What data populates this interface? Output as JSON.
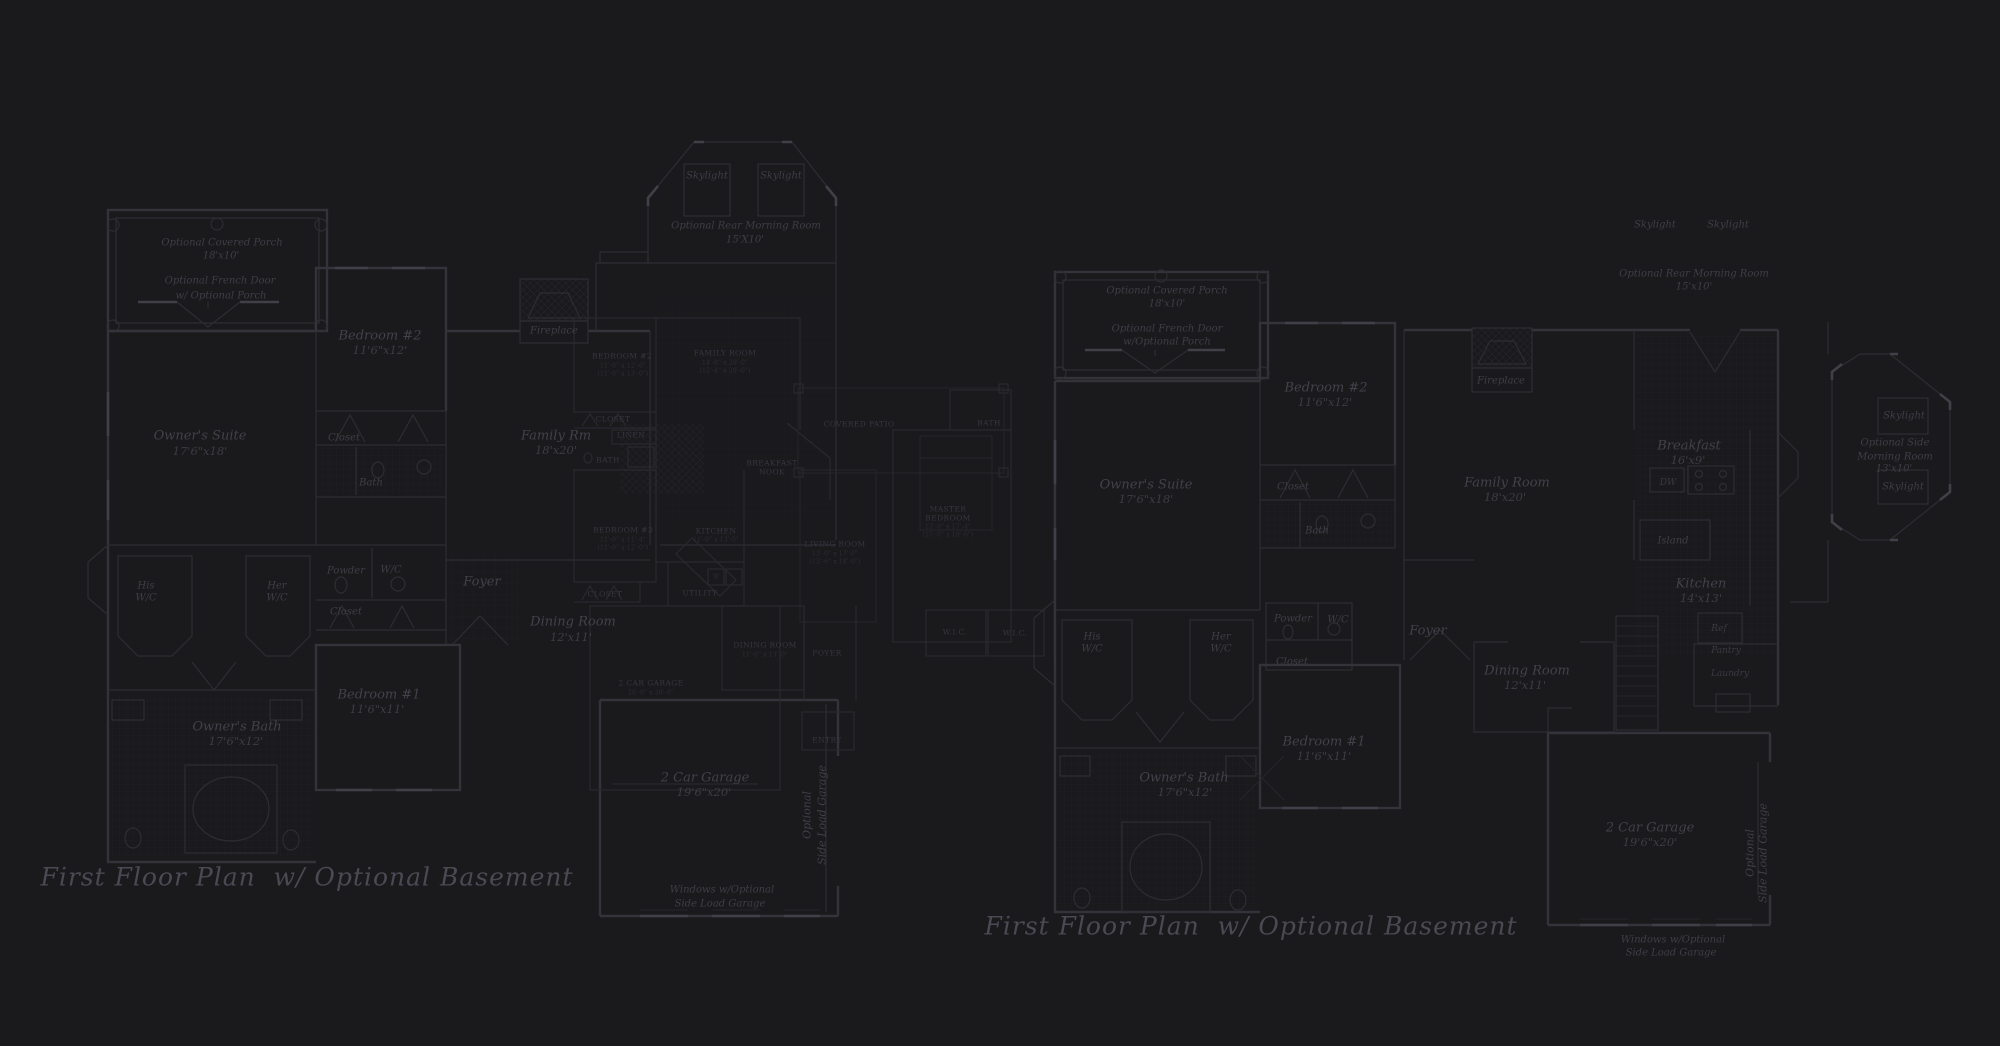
{
  "colors": {
    "background": "#1a191c",
    "wall_line": "#34333a",
    "faint_line": "#2e2d33",
    "bright_line": "#413f47",
    "label_text": "#43414a",
    "caption_text": "#4b4953"
  },
  "plans": {
    "left": {
      "caption": "First Floor Plan  w/ Optional Basement",
      "labels": [
        {
          "t": "Optional Covered Porch",
          "x": 222,
          "y": 243,
          "c": "rms"
        },
        {
          "t": "18'x10'",
          "x": 221,
          "y": 256,
          "c": "rms"
        },
        {
          "t": "Optional French Door",
          "x": 220,
          "y": 281,
          "c": "rms"
        },
        {
          "t": "w/ Optional Porch",
          "x": 221,
          "y": 296,
          "c": "rms"
        },
        {
          "t": "Bedroom #2",
          "x": 380,
          "y": 336,
          "c": "rm"
        },
        {
          "t": "11'6\"x12'",
          "x": 380,
          "y": 350,
          "c": "dim"
        },
        {
          "t": "Owner's Suite",
          "x": 200,
          "y": 436,
          "c": "rm"
        },
        {
          "t": "17'6\"x18'",
          "x": 200,
          "y": 451,
          "c": "dim"
        },
        {
          "t": "Closet",
          "x": 344,
          "y": 438,
          "c": "rms"
        },
        {
          "t": "Bath",
          "x": 371,
          "y": 483,
          "c": "rms"
        },
        {
          "t": "His",
          "x": 146,
          "y": 586,
          "c": "rms"
        },
        {
          "t": "W/C",
          "x": 146,
          "y": 598,
          "c": "rms"
        },
        {
          "t": "Her",
          "x": 277,
          "y": 586,
          "c": "rms"
        },
        {
          "t": "W/C",
          "x": 277,
          "y": 598,
          "c": "rms"
        },
        {
          "t": "Powder",
          "x": 346,
          "y": 571,
          "c": "rms"
        },
        {
          "t": "W/C",
          "x": 391,
          "y": 570,
          "c": "rms"
        },
        {
          "t": "Closet",
          "x": 346,
          "y": 612,
          "c": "rms"
        },
        {
          "t": "Foyer",
          "x": 482,
          "y": 582,
          "c": "rm"
        },
        {
          "t": "Dining Room",
          "x": 573,
          "y": 622,
          "c": "rm"
        },
        {
          "t": "12'x11'",
          "x": 571,
          "y": 637,
          "c": "dim"
        },
        {
          "t": "Family Rm",
          "x": 556,
          "y": 436,
          "c": "rm"
        },
        {
          "t": "18'x20'",
          "x": 556,
          "y": 450,
          "c": "dim"
        },
        {
          "t": "Fireplace",
          "x": 554,
          "y": 331,
          "c": "rms"
        },
        {
          "t": "Skylight",
          "x": 707,
          "y": 176,
          "c": "rms"
        },
        {
          "t": "Skylight",
          "x": 781,
          "y": 176,
          "c": "rms"
        },
        {
          "t": "Optional Rear Morning Room",
          "x": 746,
          "y": 226,
          "c": "rms"
        },
        {
          "t": "15'X10'",
          "x": 745,
          "y": 240,
          "c": "rms"
        },
        {
          "t": "Bedroom #1",
          "x": 379,
          "y": 695,
          "c": "rm"
        },
        {
          "t": "11'6\"x11'",
          "x": 377,
          "y": 709,
          "c": "dim"
        },
        {
          "t": "Owner's Bath",
          "x": 237,
          "y": 727,
          "c": "rm"
        },
        {
          "t": "17'6\"x12'",
          "x": 236,
          "y": 741,
          "c": "dim"
        },
        {
          "t": "2 Car Garage",
          "x": 705,
          "y": 778,
          "c": "rm"
        },
        {
          "t": "19'6\"x20'",
          "x": 704,
          "y": 792,
          "c": "dim"
        },
        {
          "t": "Optional",
          "x": 807,
          "y": 815,
          "c": "vert"
        },
        {
          "t": "Side Load Garage",
          "x": 822,
          "y": 815,
          "c": "vert"
        },
        {
          "t": "Windows w/Optional",
          "x": 722,
          "y": 890,
          "c": "rms"
        },
        {
          "t": "Side Load Garage",
          "x": 720,
          "y": 904,
          "c": "rms"
        }
      ]
    },
    "middle": {
      "labels": [
        {
          "t": "BEDROOM #2",
          "x": 622,
          "y": 356,
          "c": "caps"
        },
        {
          "t": "11'-0\" x 12'-6\"",
          "x": 623,
          "y": 366,
          "c": "capsdim"
        },
        {
          "t": "(11'-0\" x 13'-0\")",
          "x": 623,
          "y": 374,
          "c": "capsdim"
        },
        {
          "t": "FAMILY ROOM",
          "x": 725,
          "y": 353,
          "c": "caps"
        },
        {
          "t": "14'-8\" x 20'-0\"",
          "x": 725,
          "y": 363,
          "c": "capsdim"
        },
        {
          "t": "(15'-4\" x 20'-0\")",
          "x": 725,
          "y": 371,
          "c": "capsdim"
        },
        {
          "t": "CLOSET",
          "x": 613,
          "y": 419,
          "c": "caps"
        },
        {
          "t": "LINEN",
          "x": 631,
          "y": 435,
          "c": "caps"
        },
        {
          "t": "BATH",
          "x": 608,
          "y": 460,
          "c": "caps"
        },
        {
          "t": "BEDROOM #3",
          "x": 623,
          "y": 530,
          "c": "caps"
        },
        {
          "t": "11'-0\" x 11'-4\"",
          "x": 623,
          "y": 540,
          "c": "capsdim"
        },
        {
          "t": "(11'-0\" x 12'-0\")",
          "x": 623,
          "y": 548,
          "c": "capsdim"
        },
        {
          "t": "KITCHEN",
          "x": 716,
          "y": 531,
          "c": "caps"
        },
        {
          "t": "11'-0\" x 13'-0\"",
          "x": 716,
          "y": 540,
          "c": "capsdim"
        },
        {
          "t": "BREAKFAST",
          "x": 772,
          "y": 463,
          "c": "caps"
        },
        {
          "t": "NOOK",
          "x": 772,
          "y": 472,
          "c": "caps"
        },
        {
          "t": "COVERED PATIO",
          "x": 859,
          "y": 424,
          "c": "caps"
        },
        {
          "t": "MASTER",
          "x": 948,
          "y": 509,
          "c": "caps"
        },
        {
          "t": "BEDROOM",
          "x": 948,
          "y": 518,
          "c": "caps"
        },
        {
          "t": "13'-0\" x 17'-4\"",
          "x": 948,
          "y": 527,
          "c": "capsdim"
        },
        {
          "t": "(15'-0\" x 19'-0\")",
          "x": 948,
          "y": 535,
          "c": "capsdim"
        },
        {
          "t": "LIVING ROOM",
          "x": 835,
          "y": 544,
          "c": "caps"
        },
        {
          "t": "13'-0\" x 17'-0\"",
          "x": 835,
          "y": 554,
          "c": "capsdim"
        },
        {
          "t": "(13'-6\" x 18'-0\")",
          "x": 835,
          "y": 562,
          "c": "capsdim"
        },
        {
          "t": "BATH",
          "x": 989,
          "y": 423,
          "c": "caps"
        },
        {
          "t": "W.I.C.",
          "x": 955,
          "y": 632,
          "c": "caps"
        },
        {
          "t": "W.I.C.",
          "x": 1015,
          "y": 633,
          "c": "caps"
        },
        {
          "t": "DINING ROOM",
          "x": 765,
          "y": 645,
          "c": "caps"
        },
        {
          "t": "11'-0\" x 13'-0\"",
          "x": 765,
          "y": 655,
          "c": "capsdim"
        },
        {
          "t": "FOYER",
          "x": 827,
          "y": 653,
          "c": "caps"
        },
        {
          "t": "UTILITY",
          "x": 700,
          "y": 593,
          "c": "caps"
        },
        {
          "t": "W",
          "x": 716,
          "y": 577,
          "c": "capsdim"
        },
        {
          "t": "CLOSET",
          "x": 605,
          "y": 594,
          "c": "caps"
        },
        {
          "t": "2 CAR GARAGE",
          "x": 651,
          "y": 683,
          "c": "caps"
        },
        {
          "t": "20'-0\" x 20'-8\"",
          "x": 651,
          "y": 693,
          "c": "capsdim"
        },
        {
          "t": "ENTRY",
          "x": 827,
          "y": 740,
          "c": "caps"
        }
      ]
    },
    "right": {
      "caption": "First Floor Plan  w/ Optional Basement",
      "labels": [
        {
          "t": "Optional Covered Porch",
          "x": 1167,
          "y": 291,
          "c": "rms"
        },
        {
          "t": "18'x10'",
          "x": 1167,
          "y": 304,
          "c": "rms"
        },
        {
          "t": "Optional French Door",
          "x": 1167,
          "y": 329,
          "c": "rms"
        },
        {
          "t": "w/Optional Porch",
          "x": 1167,
          "y": 342,
          "c": "rms"
        },
        {
          "t": "Bedroom #2",
          "x": 1326,
          "y": 388,
          "c": "rm"
        },
        {
          "t": "11'6\"x12'",
          "x": 1325,
          "y": 402,
          "c": "dim"
        },
        {
          "t": "Owner's Suite",
          "x": 1146,
          "y": 485,
          "c": "rm"
        },
        {
          "t": "17'6\"x18'",
          "x": 1146,
          "y": 499,
          "c": "dim"
        },
        {
          "t": "Closet",
          "x": 1293,
          "y": 487,
          "c": "rms"
        },
        {
          "t": "Bath",
          "x": 1317,
          "y": 531,
          "c": "rms"
        },
        {
          "t": "Family Room",
          "x": 1507,
          "y": 483,
          "c": "rm"
        },
        {
          "t": "18'x20'",
          "x": 1505,
          "y": 497,
          "c": "dim"
        },
        {
          "t": "Fireplace",
          "x": 1501,
          "y": 381,
          "c": "rms"
        },
        {
          "t": "Skylight",
          "x": 1655,
          "y": 225,
          "c": "rms"
        },
        {
          "t": "Skylight",
          "x": 1728,
          "y": 225,
          "c": "rms"
        },
        {
          "t": "Optional Rear Morning Room",
          "x": 1694,
          "y": 274,
          "c": "rms"
        },
        {
          "t": "15'x10'",
          "x": 1694,
          "y": 287,
          "c": "rms"
        },
        {
          "t": "Breakfast",
          "x": 1689,
          "y": 446,
          "c": "rm"
        },
        {
          "t": "16'x9'",
          "x": 1688,
          "y": 460,
          "c": "dim"
        },
        {
          "t": "DW",
          "x": 1668,
          "y": 483,
          "c": "xs"
        },
        {
          "t": "Island",
          "x": 1673,
          "y": 541,
          "c": "rms"
        },
        {
          "t": "Kitchen",
          "x": 1701,
          "y": 584,
          "c": "rm"
        },
        {
          "t": "14'x13'",
          "x": 1701,
          "y": 598,
          "c": "dim"
        },
        {
          "t": "Ref",
          "x": 1719,
          "y": 629,
          "c": "xs"
        },
        {
          "t": "Pantry",
          "x": 1726,
          "y": 651,
          "c": "xs"
        },
        {
          "t": "Laundry",
          "x": 1730,
          "y": 674,
          "c": "xs"
        },
        {
          "t": "His",
          "x": 1092,
          "y": 637,
          "c": "rms"
        },
        {
          "t": "W/C",
          "x": 1092,
          "y": 649,
          "c": "rms"
        },
        {
          "t": "Her",
          "x": 1221,
          "y": 637,
          "c": "rms"
        },
        {
          "t": "W/C",
          "x": 1221,
          "y": 649,
          "c": "rms"
        },
        {
          "t": "Powder",
          "x": 1293,
          "y": 619,
          "c": "rms"
        },
        {
          "t": "W/C",
          "x": 1338,
          "y": 620,
          "c": "rms"
        },
        {
          "t": "Closet",
          "x": 1292,
          "y": 662,
          "c": "rms"
        },
        {
          "t": "Foyer",
          "x": 1428,
          "y": 631,
          "c": "rm"
        },
        {
          "t": "Dining Room",
          "x": 1527,
          "y": 671,
          "c": "rm"
        },
        {
          "t": "12'x11'",
          "x": 1525,
          "y": 685,
          "c": "dim"
        },
        {
          "t": "Bedroom #1",
          "x": 1324,
          "y": 742,
          "c": "rm"
        },
        {
          "t": "11'6\"x11'",
          "x": 1324,
          "y": 756,
          "c": "dim"
        },
        {
          "t": "Owner's Bath",
          "x": 1184,
          "y": 778,
          "c": "rm"
        },
        {
          "t": "17'6\"x12'",
          "x": 1185,
          "y": 792,
          "c": "dim"
        },
        {
          "t": "Skylight",
          "x": 1904,
          "y": 416,
          "c": "rms"
        },
        {
          "t": "Optional Side",
          "x": 1895,
          "y": 443,
          "c": "rms"
        },
        {
          "t": "Morning Room",
          "x": 1895,
          "y": 457,
          "c": "rms"
        },
        {
          "t": "13'x10'",
          "x": 1894,
          "y": 469,
          "c": "rms"
        },
        {
          "t": "Skylight",
          "x": 1903,
          "y": 487,
          "c": "rms"
        },
        {
          "t": "2 Car Garage",
          "x": 1650,
          "y": 828,
          "c": "rm"
        },
        {
          "t": "19'6\"x20'",
          "x": 1650,
          "y": 842,
          "c": "dim"
        },
        {
          "t": "Optional",
          "x": 1750,
          "y": 853,
          "c": "vert"
        },
        {
          "t": "Side Load Garage",
          "x": 1763,
          "y": 853,
          "c": "vert"
        },
        {
          "t": "Windows w/Optional",
          "x": 1673,
          "y": 940,
          "c": "rms"
        },
        {
          "t": "Side Load Garage",
          "x": 1671,
          "y": 953,
          "c": "rms"
        }
      ]
    }
  }
}
